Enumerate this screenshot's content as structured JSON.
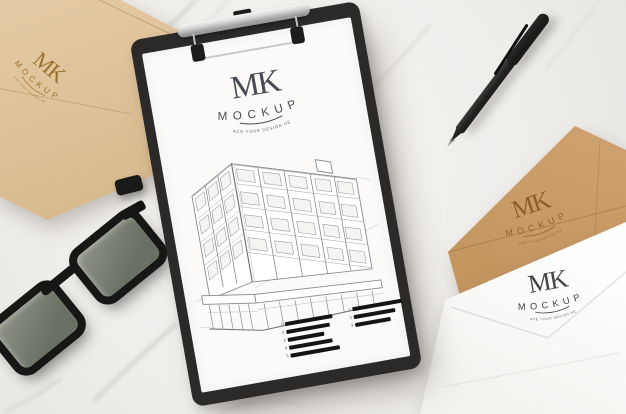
{
  "brand": {
    "initials": "MK",
    "name": "MOCKUP",
    "tagline": "PLACE YOUR DESIGN HERE"
  },
  "clipboard": {
    "bars_left": [
      {
        "m": "1",
        "w": "48px"
      },
      {
        "m": "2",
        "w": "44px"
      },
      {
        "m": "3",
        "w": "37px"
      },
      {
        "m": "4",
        "w": "44px"
      },
      {
        "m": "5",
        "w": "50px"
      }
    ],
    "bars_right": [
      {
        "m": "1",
        "w": "50px"
      },
      {
        "m": "2",
        "w": "42px"
      },
      {
        "m": "3",
        "w": "36px"
      }
    ]
  },
  "colors": {
    "marble": "#f0eeec",
    "clipboard_frame": "#2b2a28",
    "paper": "#fbfaf8",
    "envelope_tan": "#dcc099",
    "envelope_kraft": "#c89a66",
    "envelope_white": "#fcfcfa",
    "stamp_tan": "#9c702f",
    "stamp_kraft": "#8a5f2c",
    "ink": "#47474f",
    "sketch_stroke": "#85878c"
  }
}
